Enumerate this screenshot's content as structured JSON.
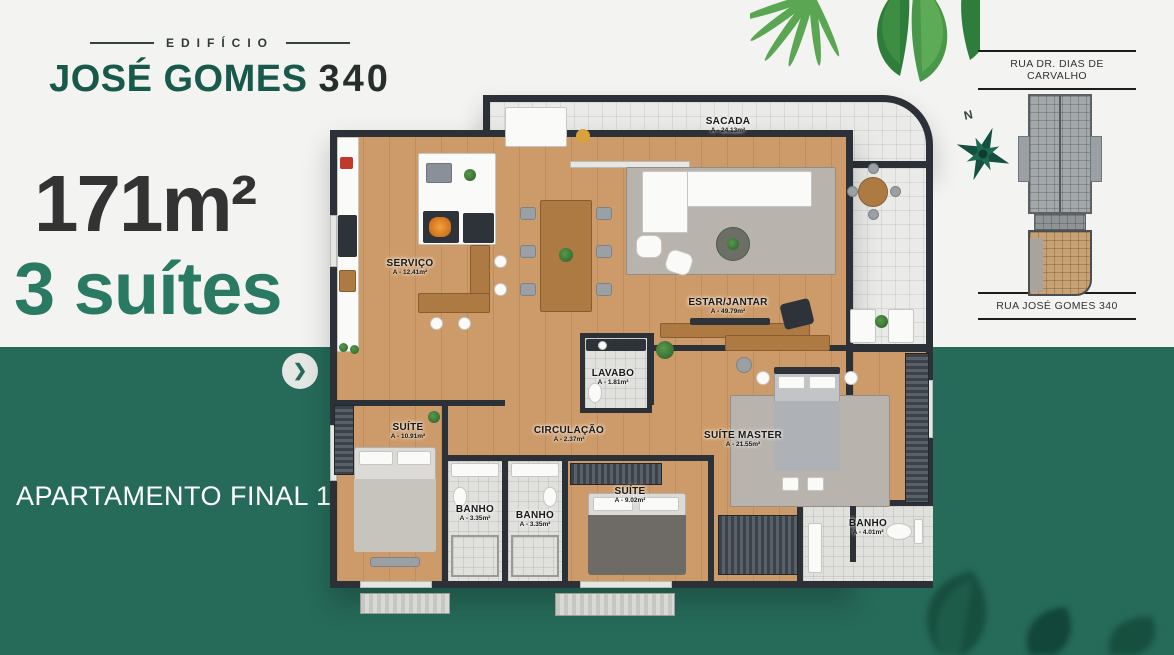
{
  "brand": {
    "edificio": "EDIFÍCIO",
    "name": "JOSÉ GOMES",
    "number": "340"
  },
  "stats": {
    "area": "171m²",
    "suites": "3 suítes"
  },
  "banner": {
    "label": "APARTAMENTO FINAL 1",
    "arrow_glyph": "❯"
  },
  "sidebar": {
    "street_top": "RUA DR. DIAS DE CARVALHO",
    "street_bottom": "RUA JOSÉ GOMES 340",
    "compass_n": "N"
  },
  "plan": {
    "rooms": [
      {
        "name": "SACADA",
        "area": "A - 24.13m²"
      },
      {
        "name": "SERVIÇO",
        "area": "A - 12.41m²"
      },
      {
        "name": "ESTAR/JANTAR",
        "area": "A - 49.79m²"
      },
      {
        "name": "LAVABO",
        "area": "A - 1.81m²"
      },
      {
        "name": "CIRCULAÇÃO",
        "area": "A - 2.37m²"
      },
      {
        "name": "SUÍTE",
        "area": "A - 10.91m²"
      },
      {
        "name": "SUÍTE MASTER",
        "area": "A - 21.55m²"
      },
      {
        "name": "BANHO",
        "area": "A - 3.35m²"
      },
      {
        "name": "BANHO",
        "area": "A - 3.35m²"
      },
      {
        "name": "SUÍTE",
        "area": "A - 9.02m²"
      },
      {
        "name": "BANHO",
        "area": "A - 4.01m²"
      }
    ]
  },
  "colors": {
    "brand_green": "#17594a",
    "accent_green": "#266a59",
    "suites_green": "#2a7a63",
    "dark_text": "#333333",
    "wall": "#2c3137",
    "wood_floor": "#cd9b69",
    "tile": "#eaeae8",
    "bg_light": "#f3f3f1"
  }
}
